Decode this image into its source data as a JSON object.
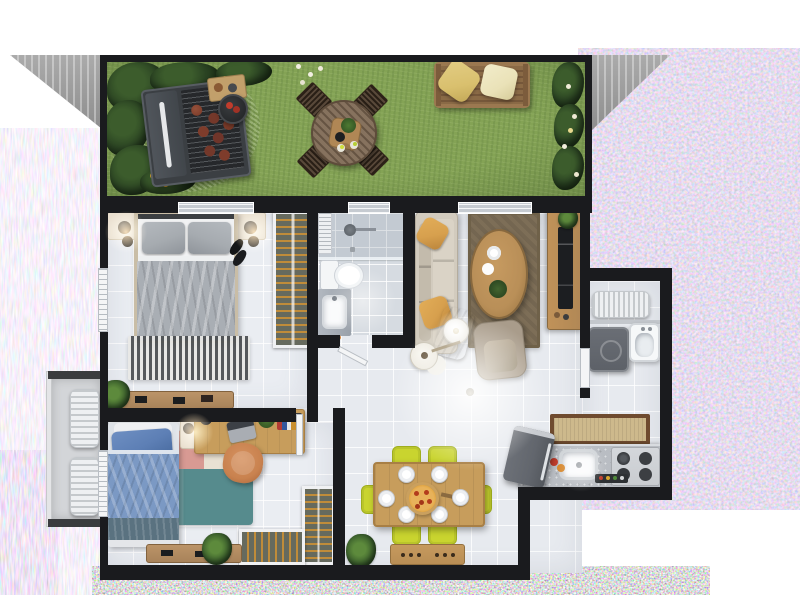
{
  "scene": {
    "title": "3D rendered top-down floor plan of a two-bedroom apartment with private garden",
    "canvas": {
      "width": 800,
      "height": 595
    },
    "notes": "photorealistic dollhouse-view render; no visible text labels; image bordered by pink/multicolor compression-noise static on right, left and bottom edges; gray ground wedges at top corners"
  },
  "palette": {
    "wall": "#1a1b1e",
    "grass": "#84a355",
    "gravel": "#9b9b92",
    "bush": "#2b4423",
    "tableWood": "#7d6752",
    "chairWood": "#4a3828",
    "benchWood": "#9b7850",
    "pillowGold": "#d9c06e",
    "pillowCream": "#eae2b8",
    "grill": "#3b3f43",
    "grate": "#26282b",
    "burger": "#7a3a28",
    "floorMain": "#e7eaef",
    "floorBed": "#eaedf2",
    "floorBath": "#d6dbe1",
    "balcony": "#d3d5d8",
    "track": "#c6cbd1",
    "white": "#f4f5f6",
    "bedFrame": "#c9bda6",
    "pillowGray": "#a6abb0",
    "blanketGray": "#a9aeb4",
    "rugDark": "#4a4d50",
    "wardrobe": "#666a5e",
    "hanger": "#c08c3a",
    "benchWood2": "#a8835a",
    "sofa": "#d2cbbe",
    "mustard": "#d7a04e",
    "throw": "#dbcfb8",
    "rugBrown": "#7d6e57",
    "ovalWood": "#b98f58",
    "tvWood": "#b08755",
    "tv": "#1c1e21",
    "armchair": "#a99c8b",
    "ac": "#eef0f2",
    "washer": "#5d6168",
    "counter": "#b9bdc3",
    "steel": "#c9ccd0",
    "burner": "#3c3f43",
    "rugTan": "#cdb98c",
    "rugTanEdge": "#6f4b2f",
    "fridge": "#62666d",
    "dtable": "#c79d5c",
    "lime": "#c9d42f",
    "limeEdge": "#9fae1e",
    "sideboard": "#b98e55",
    "pizza": "#e0a23a",
    "pizzaTop": "#b33c1c",
    "bluePillow": "#5d7fb5",
    "duvet": "#7b99c4",
    "duvetFoot": "#5a7280",
    "rugPink": "#d89a93",
    "rugTeal": "#568b8d",
    "rugCream": "#e9e1d3",
    "deskChair": "#c9824f",
    "plant": "#35582a",
    "nightstand": "#e9dfcf"
  },
  "rooms": [
    {
      "id": "garden",
      "label": "Garden / backyard with lawn",
      "items": [
        "barbecue-grill with burgers",
        "charcoal-kettle",
        "wood side table",
        "round wooden dining table",
        "4 wooden garden chairs",
        "wooden garden bench with 2 cream pillows",
        "gravel patch",
        "shrubs and flower beds",
        "white and yellow flowers"
      ]
    },
    {
      "id": "bedroom-1",
      "label": "Master bedroom",
      "items": [
        "double bed with gray pillows and blanket",
        "2 nightstands with pendant lamps",
        "pair of shoes",
        "striped area rug",
        "open wardrobe with clothes hangers",
        "wooden bench with decor",
        "potted plant",
        "window",
        "sliding door to garden"
      ]
    },
    {
      "id": "bathroom",
      "label": "Bathroom",
      "items": [
        "walk-in shower with shower head",
        "toilet",
        "vanity with sink",
        "louvered panel",
        "frosted window"
      ]
    },
    {
      "id": "living-room",
      "label": "Living room",
      "items": [
        "beige sofa with mustard pillows and throw",
        "brown area rug",
        "oval wooden coffee table with cups and plant",
        "armchair",
        "round floor lamp",
        "guitar",
        "TV sideboard with television and plant",
        "sliding door to garden",
        "ceiling light glow"
      ]
    },
    {
      "id": "service-area",
      "label": "Laundry / service area",
      "items": [
        "AC condenser unit",
        "washing machine",
        "laundry sink",
        "service door"
      ]
    },
    {
      "id": "kitchen",
      "label": "Kitchen",
      "items": [
        "refrigerator (angled)",
        "countertop with sink",
        "4-burner gas cooktop",
        "knob panel",
        "fruit",
        "tan kitchen runner rug"
      ]
    },
    {
      "id": "dining-area",
      "label": "Dining area",
      "items": [
        "wooden dining table",
        "6 lime-yellow chairs",
        "6 white plates",
        "pizza on serving board",
        "wooden sideboard",
        "palm plant"
      ]
    },
    {
      "id": "bedroom-2",
      "label": "Second bedroom",
      "items": [
        "single bed with blue bedding",
        "color-block rug (cream/pink/teal)",
        "nightstand with lamp",
        "wooden desk with laptop, desk lamp, books and plant",
        "orange desk chair",
        "L-shaped open wardrobe with hangers",
        "wooden bench",
        "palm plant",
        "window"
      ]
    },
    {
      "id": "side-balcony",
      "label": "Side service ledge",
      "items": [
        "2 AC condenser units"
      ]
    }
  ],
  "artifacts": {
    "right_edge": "dense pastel pink/multicolor noise",
    "left_edge": "sparse vertical color streak noise",
    "bottom_edge": "dense multicolor confetti noise band",
    "top_corners": "gray ground wedges with white streaks"
  }
}
